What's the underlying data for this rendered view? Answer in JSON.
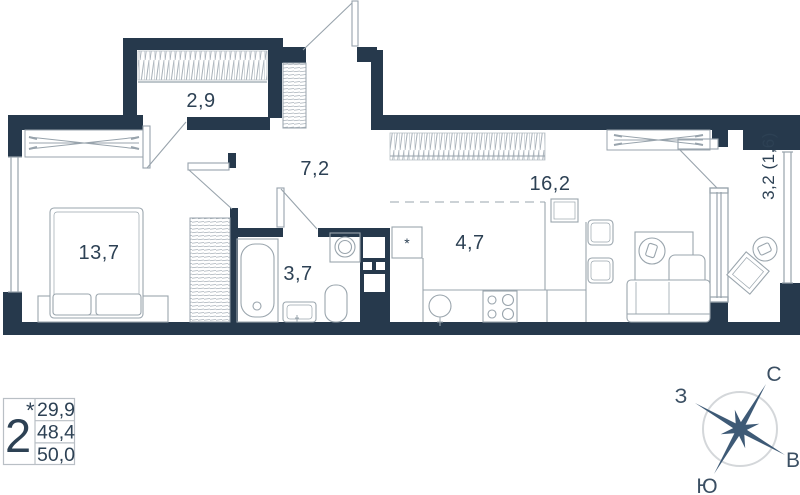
{
  "plan": {
    "rooms": [
      {
        "name": "wardrobe",
        "area": "2,9"
      },
      {
        "name": "hall",
        "area": "7,2"
      },
      {
        "name": "bedroom",
        "area": "13,7"
      },
      {
        "name": "bathroom",
        "area": "3,7"
      },
      {
        "name": "kitchen",
        "area": "4,7"
      },
      {
        "name": "living",
        "area": "16,2"
      },
      {
        "name": "balcony",
        "area": "3,2 (1,6)"
      }
    ],
    "kitchen_mark": "*"
  },
  "legend": {
    "unit_count": "2",
    "unit_mark": "*",
    "areas": [
      "29,9",
      "48,4",
      "50,0"
    ]
  },
  "compass": {
    "n": "С",
    "e": "В",
    "s": "Ю",
    "w": "З"
  },
  "colors": {
    "wall": "#26394c",
    "line": "#98a3ac",
    "text": "#2d4154",
    "star": "#3e5a76",
    "compass_ring": "#d4d7da"
  }
}
